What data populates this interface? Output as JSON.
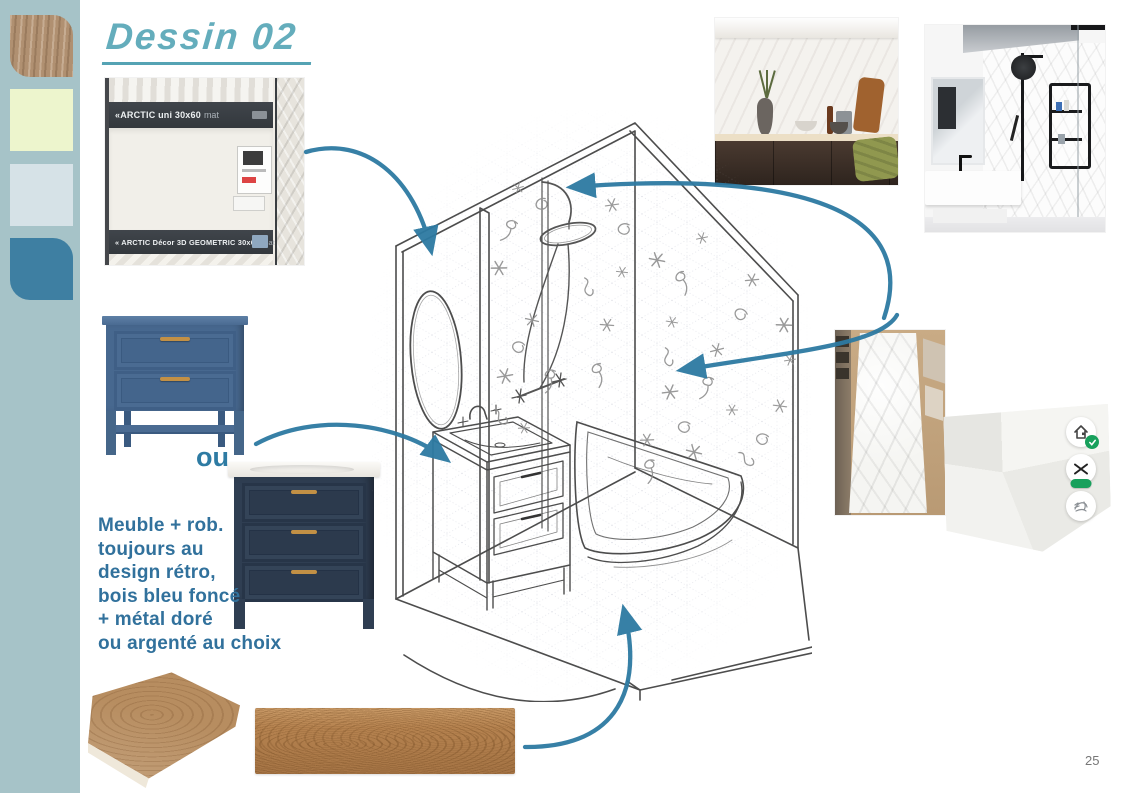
{
  "document": {
    "title": "Dessin 02",
    "page_number": "25"
  },
  "palette": {
    "strip_color": "#a6c3c8",
    "swatches": [
      {
        "name": "wood-texture"
      },
      {
        "name": "pale-yellow",
        "color": "#edf5cd"
      },
      {
        "name": "light-blue",
        "color": "#d6e2e7"
      },
      {
        "name": "steel-blue",
        "color": "#3e7fa2"
      }
    ]
  },
  "tile_display": {
    "top_label": "«ARCTIC uni 30x60",
    "top_suffix": "mat",
    "bottom_label": "« ARCTIC Décor 3D GEOMETRIC 30x60",
    "bottom_suffix": "mat »"
  },
  "vanity_options": {
    "separator_label": "ou"
  },
  "annotation": {
    "lines": [
      "Meuble + rob.",
      "toujours au",
      "design rétro,",
      "bois bleu foncé",
      "+ métal doré",
      "ou argenté au choix"
    ],
    "text_color": "#31719c"
  },
  "accents": {
    "arrow_color": "#2d7aa2",
    "title_color": "#64adbc",
    "badge_green": "#18a05c"
  }
}
